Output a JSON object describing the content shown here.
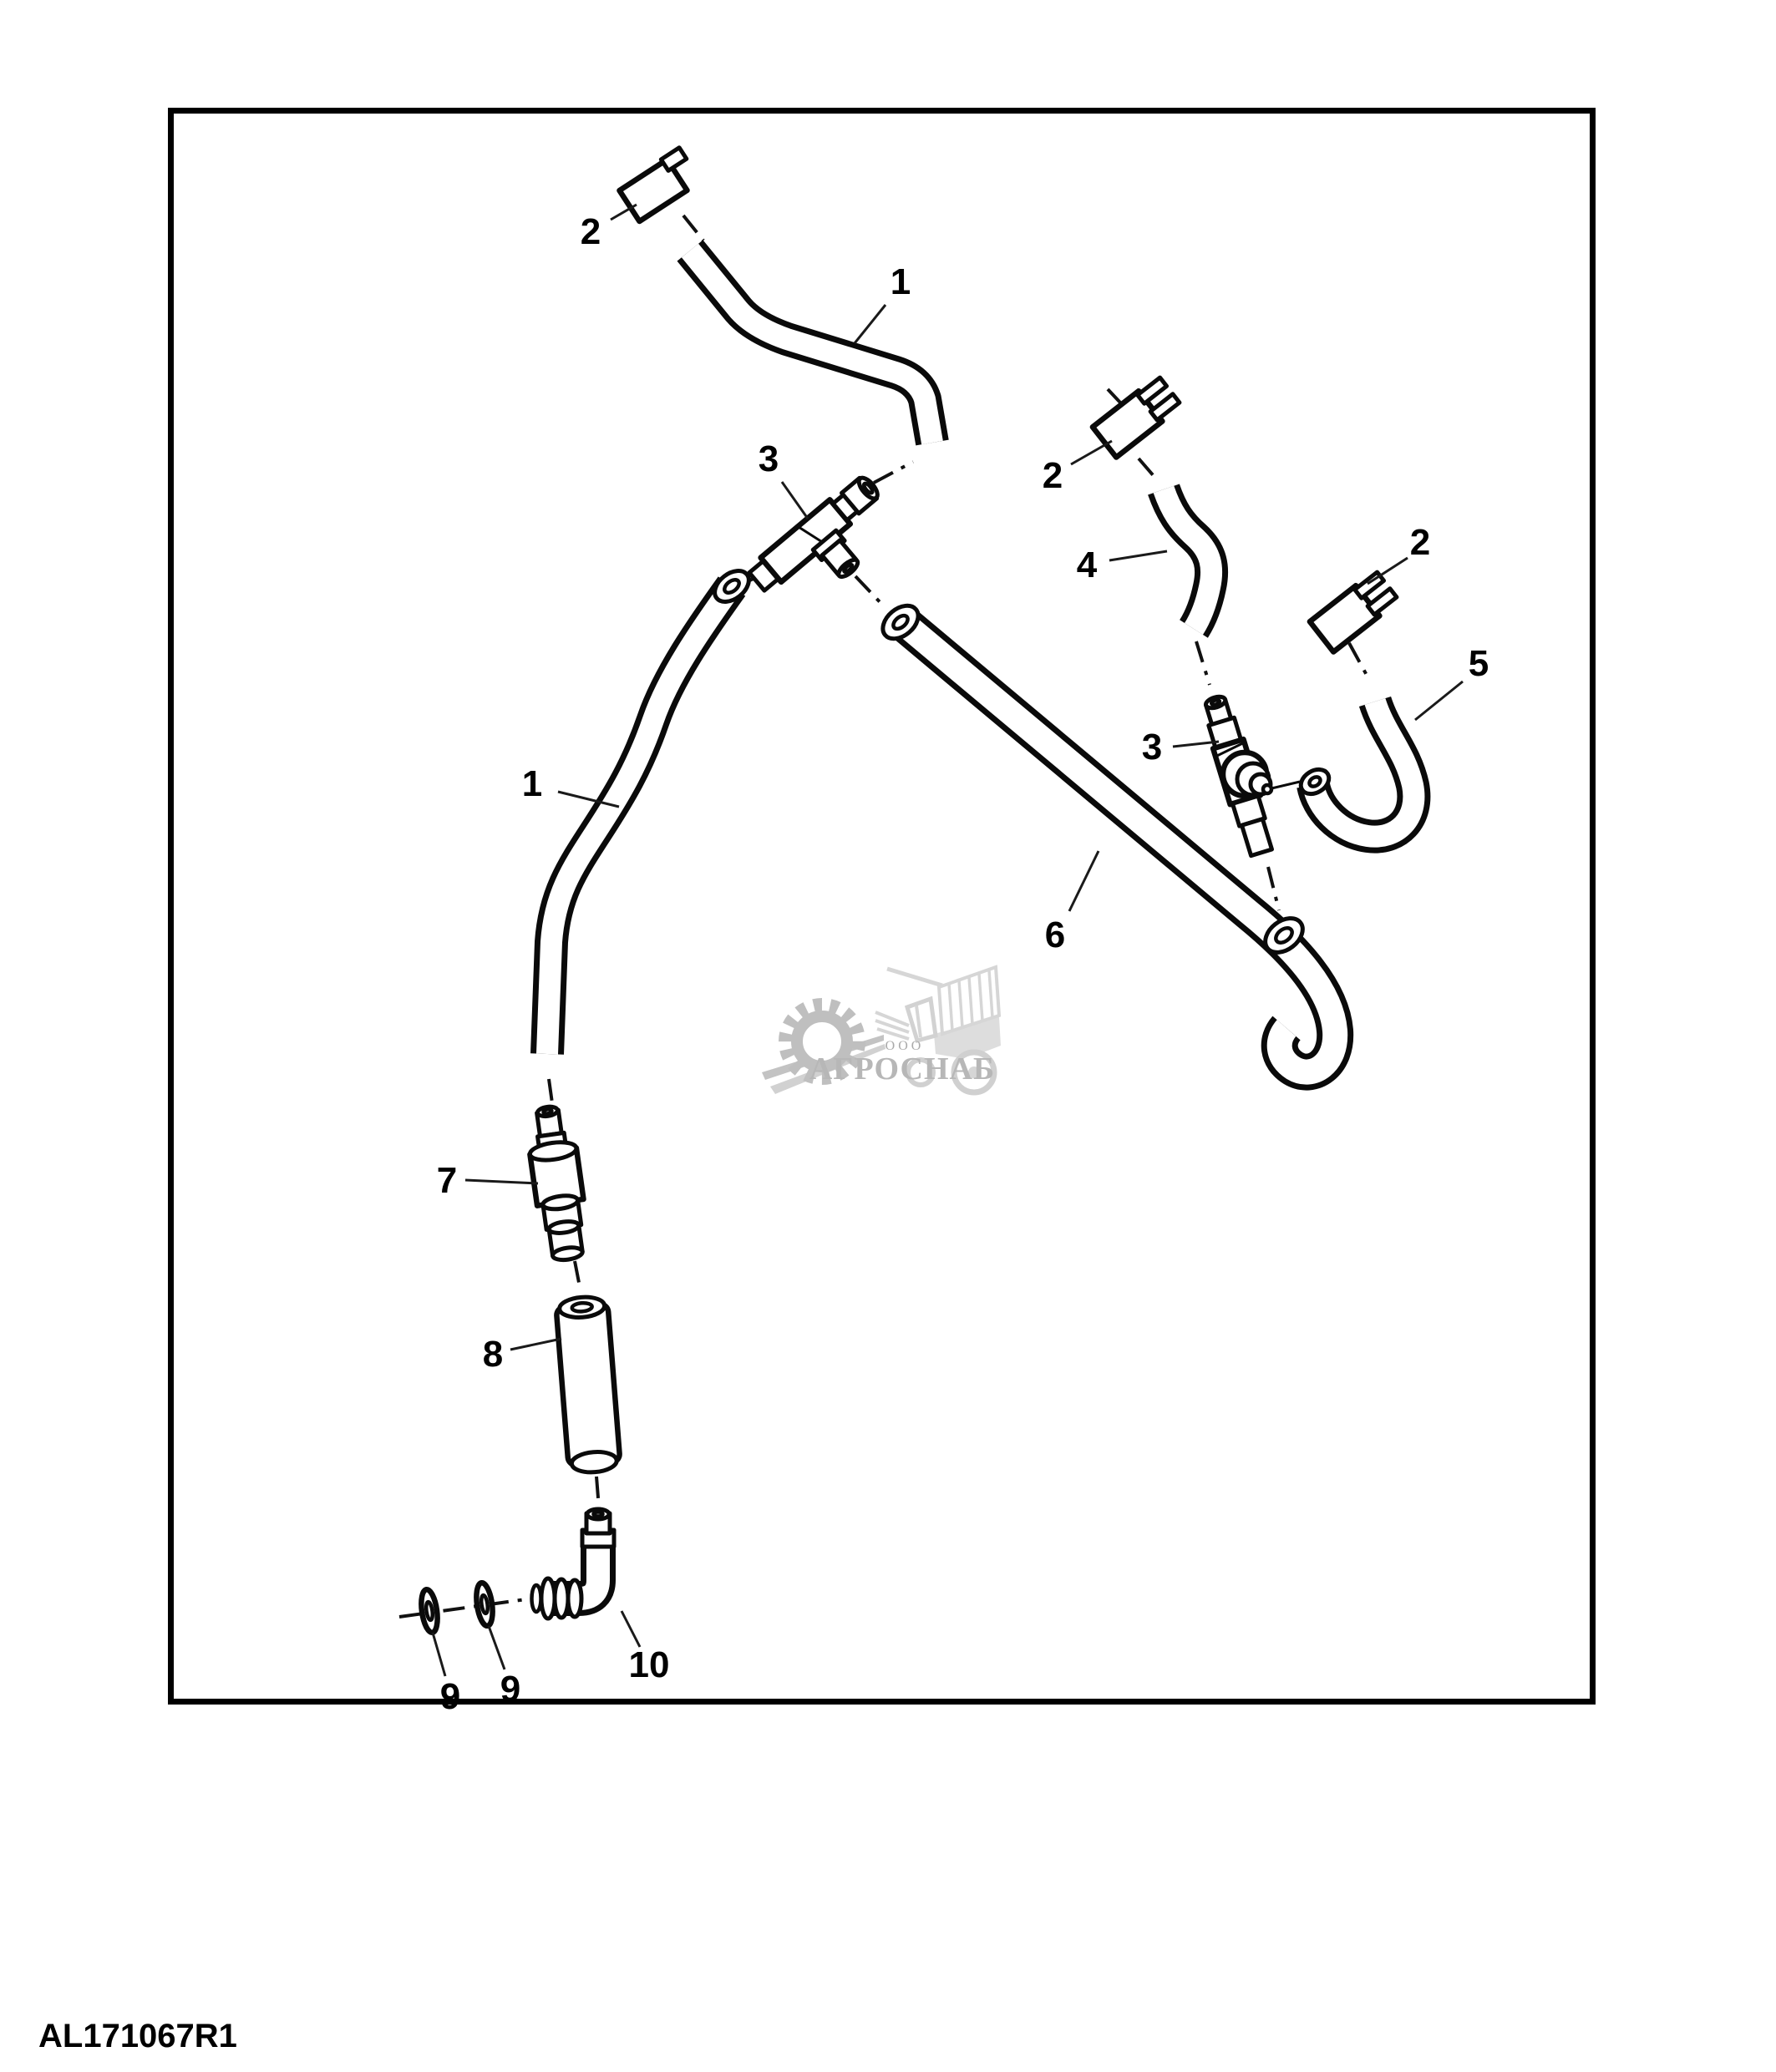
{
  "diagram": {
    "callouts": {
      "hose_front_upper": "1",
      "hose_front_lower": "1",
      "clip_top": "2",
      "clip_middle": "2",
      "clip_right": "2",
      "tee_fitting_left": "3",
      "tee_fitting_right": "3",
      "hose_elbow_short": "4",
      "hose_hook": "5",
      "hose_long_rear": "6",
      "inline_connector": "7",
      "tube": "8",
      "washer_outer": "9",
      "washer_inner": "9",
      "elbow_fitting": "10"
    },
    "drawing_number": "AL171067R1"
  },
  "watermark": {
    "org_prefix": "ООО",
    "org_name": "АГРОСНАБ"
  }
}
